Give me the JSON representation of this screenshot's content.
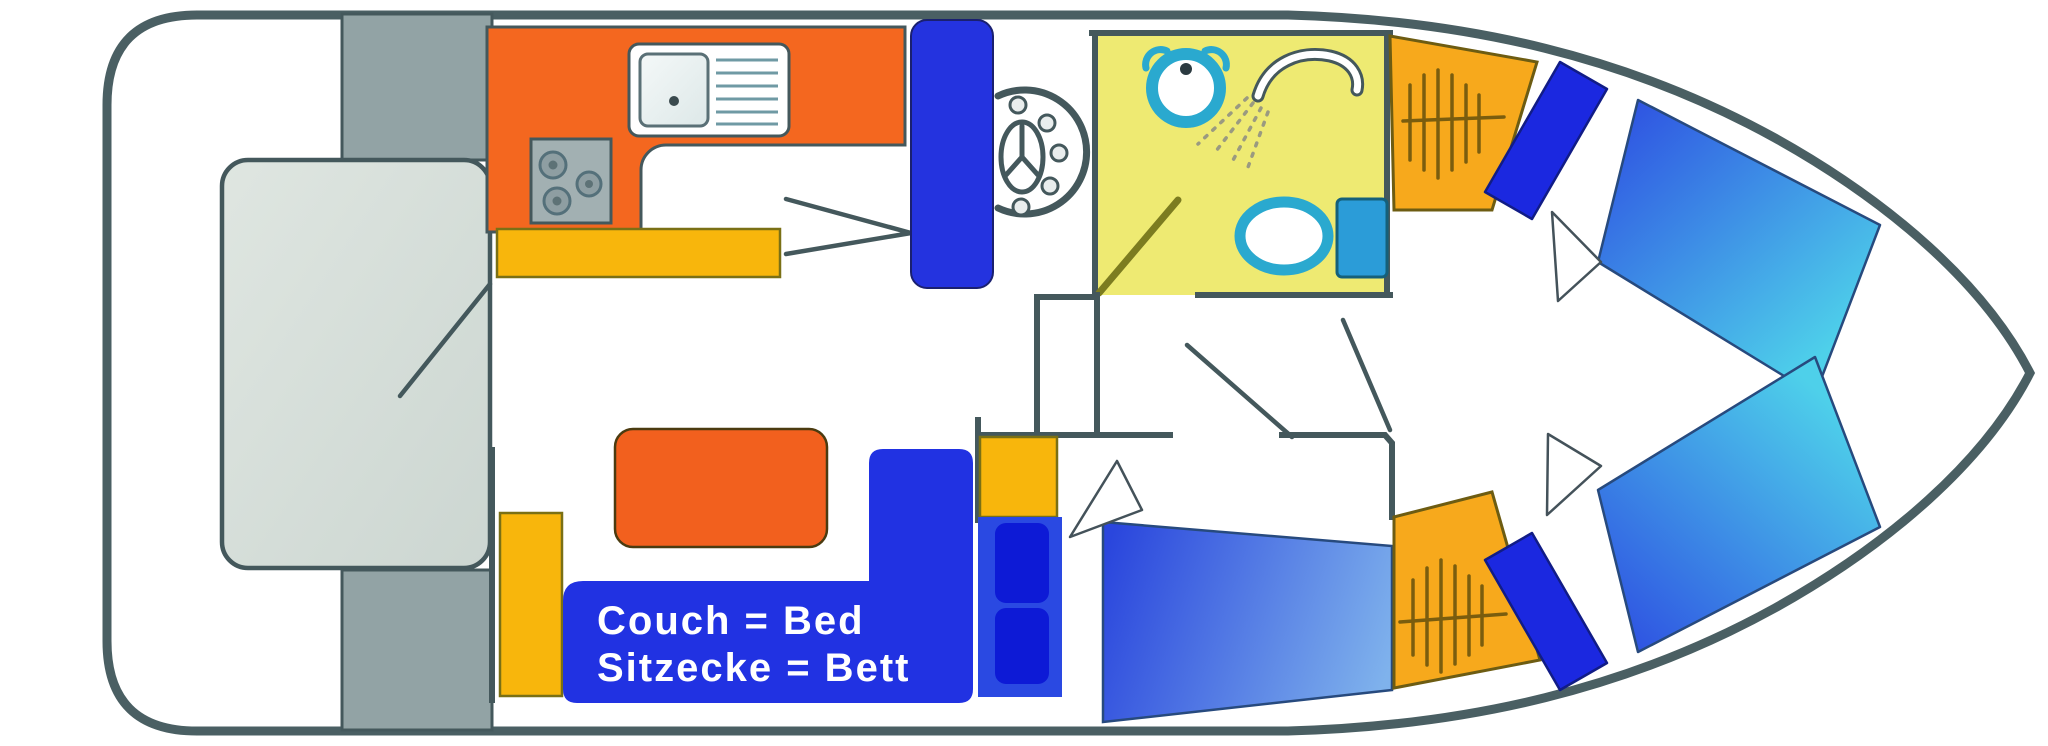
{
  "legend": {
    "line1": "Couch = Bed",
    "line2": "Sitzecke = Bett"
  },
  "colors": {
    "hull_outline": "#4a5f63",
    "side_deck_gray": "#92a3a5",
    "aft_berth_gray": "#dae1dc",
    "galley_orange": "#f4671f",
    "table_orange": "#f2601e",
    "counter_yellow": "#f8b60c",
    "bow_cabinet_yellow": "#f7a91c",
    "royal_blue": "#2132e2",
    "pillow_blue": "#1b28e0",
    "bathroom_floor_yellow": "#eeea72",
    "fixture_teal": "#2aa9cf",
    "cistern_blue": "#2b9cd8",
    "door_olive": "#7c7c20",
    "mattress_gradient_start": "#2f55e2",
    "mattress_gradient_end": "#4ed0ea"
  },
  "icons": [
    "steering-wheel-icon",
    "kitchen-sink-icon",
    "stove-icon",
    "washbasin-icon",
    "shower-icon",
    "toilet-icon",
    "companionway-steps-icon",
    "bed-marker-icon"
  ]
}
